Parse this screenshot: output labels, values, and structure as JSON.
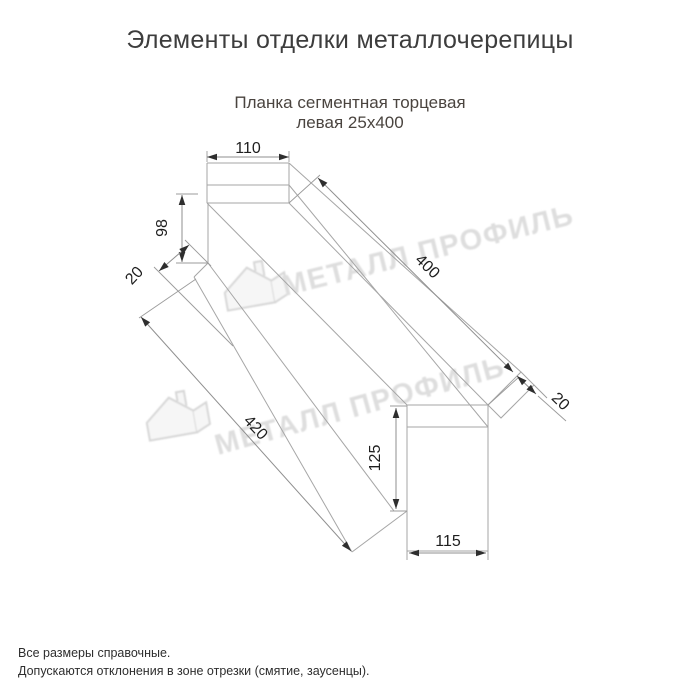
{
  "page": {
    "title": "Элементы отделки металлочерепицы",
    "product": {
      "line1": "Планка сегментная торцевая",
      "line2": "левая 25х400"
    }
  },
  "drawing": {
    "dims": {
      "top_face_width": "110",
      "side_height": "98",
      "near_hem": "20",
      "top_length": "400",
      "far_hem": "20",
      "bottom_length": "420",
      "end_height": "125",
      "end_width": "115"
    }
  },
  "watermark": {
    "text": "МЕТАЛЛ ПРОФИЛЬ"
  },
  "footer": {
    "line1": "Все размеры справочные.",
    "line2": "Допускаются отклонения в зоне отрезки (смятие, заусенцы)."
  },
  "colors": {
    "title": "#3d3d3d",
    "subtitle": "#4a443f",
    "dimension_text": "#1e1e1e",
    "drawing_line": "#a6a6a6",
    "arrow": "#2e2e2e",
    "watermark": "#dedede"
  }
}
